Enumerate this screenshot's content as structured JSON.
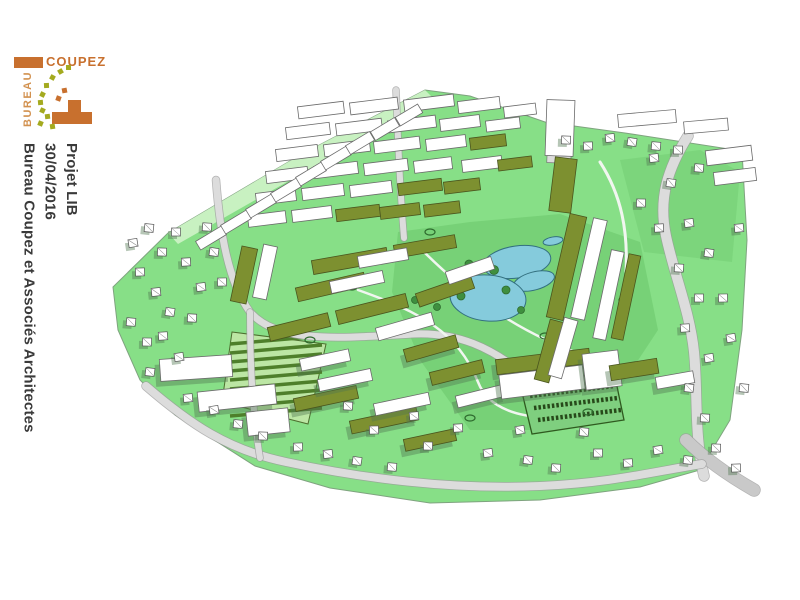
{
  "meta": {
    "title_lines": [
      "Projet LIB",
      "30/04/2016",
      "Bureau Coupez et Associés Architectes"
    ]
  },
  "logo": {
    "word_top": "COUPEZ",
    "word_side": "BUREAU",
    "orange": "#C8702E",
    "olive": "#A4AA1F",
    "squares": [
      [
        44,
        14,
        "olive"
      ],
      [
        52,
        10,
        "olive"
      ],
      [
        36,
        20,
        "olive"
      ],
      [
        30,
        28,
        "olive"
      ],
      [
        26,
        37,
        "olive"
      ],
      [
        24,
        45,
        "olive"
      ],
      [
        26,
        53,
        "olive"
      ],
      [
        31,
        59,
        "olive"
      ],
      [
        24,
        66,
        "olive"
      ],
      [
        36,
        69,
        "olive"
      ],
      [
        42,
        41,
        "orange"
      ],
      [
        48,
        33,
        "orange"
      ]
    ]
  },
  "colors": {
    "grass": "#87DF87",
    "grass_dark": "#63C063",
    "slope": "#CFF3C8",
    "terrain_edge": "#7FA37F",
    "water": "#85CBDC",
    "water_edge": "#33707F",
    "roof": "#7D9030",
    "roof_edge": "#4A551E",
    "line": "#6B6B6B",
    "white": "#FFFFFF",
    "road": "#DCDCDC",
    "road2": "#C9C9C9",
    "path": "#F1F6F0",
    "road_edge": "#9B9B9B",
    "shadow": "rgba(80,120,80,0.42)",
    "garden_light": "#BCE6A4",
    "garden_dark": "#4E7F2B",
    "parking": "#7FCF7F",
    "parking_edge": "#2F5A1F",
    "stall": "#27491A",
    "tree": "#3F8F3F",
    "tree_edge": "#2E6B2E"
  },
  "scene": {
    "terrain": [
      [
        113,
        287
      ],
      [
        168,
        233
      ],
      [
        300,
        155
      ],
      [
        425,
        90
      ],
      [
        470,
        96
      ],
      [
        545,
        122
      ],
      [
        625,
        133
      ],
      [
        742,
        151
      ],
      [
        747,
        240
      ],
      [
        742,
        330
      ],
      [
        730,
        420
      ],
      [
        700,
        470
      ],
      [
        640,
        487
      ],
      [
        540,
        500
      ],
      [
        430,
        503
      ],
      [
        330,
        488
      ],
      [
        255,
        466
      ],
      [
        175,
        415
      ],
      [
        140,
        380
      ],
      [
        118,
        330
      ]
    ],
    "slope": [
      [
        168,
        233
      ],
      [
        300,
        155
      ],
      [
        425,
        90
      ],
      [
        434,
        99
      ],
      [
        308,
        170
      ],
      [
        178,
        244
      ]
    ],
    "dark_patches": [
      {
        "pts": [
          [
            398,
            232
          ],
          [
            470,
            222
          ],
          [
            560,
            214
          ],
          [
            640,
            242
          ],
          [
            658,
            330
          ],
          [
            600,
            418
          ],
          [
            560,
            430
          ],
          [
            470,
            430
          ],
          [
            420,
            360
          ],
          [
            392,
            292
          ]
        ],
        "o": 0.45
      },
      {
        "pts": [
          [
            620,
            160
          ],
          [
            700,
            150
          ],
          [
            740,
            172
          ],
          [
            732,
            262
          ],
          [
            644,
            252
          ]
        ],
        "o": 0.3
      }
    ],
    "garden": {
      "pts": [
        [
          232,
          332
        ],
        [
          326,
          344
        ],
        [
          308,
          424
        ],
        [
          222,
          402
        ]
      ],
      "lines": [
        [
          230,
          344,
          322,
          336
        ],
        [
          230,
          353,
          322,
          345
        ],
        [
          230,
          362,
          322,
          354
        ],
        [
          230,
          371,
          322,
          363
        ],
        [
          230,
          380,
          322,
          372
        ],
        [
          230,
          389,
          322,
          381
        ],
        [
          230,
          398,
          322,
          390
        ],
        [
          230,
          407,
          322,
          399
        ],
        [
          230,
          416,
          322,
          408
        ]
      ]
    },
    "roads": [
      {
        "d": "M688,136 C668,168 658,198 666,236 C674,274 690,312 694,352 C698,392 694,436 704,476",
        "w": 10,
        "c": "road"
      },
      {
        "d": "M686,440 C702,456 726,474 754,490",
        "w": 12,
        "c": "road2"
      },
      {
        "d": "M146,386 C190,424 228,450 286,462 C360,478 450,490 540,486 C610,483 652,472 702,464",
        "w": 8,
        "c": "road"
      },
      {
        "d": "M396,90 C398,140 400,190 404,238",
        "w": 6,
        "c": "road"
      },
      {
        "d": "M216,180 C220,232 228,282 250,312 C278,344 340,338 414,334 C460,332 492,350 516,368",
        "w": 7,
        "c": "road"
      },
      {
        "d": "M250,312 C250,360 252,410 260,458",
        "w": 6,
        "c": "road"
      },
      {
        "d": "M420,248 C460,288 510,330 586,356",
        "w": 2.5,
        "c": "path"
      },
      {
        "d": "M358,290 C420,312 458,332 478,382 C488,408 520,420 560,416",
        "w": 2.5,
        "c": "path"
      },
      {
        "d": "M600,162 C622,196 628,232 626,272",
        "w": 3,
        "c": "path"
      }
    ],
    "parking": {
      "pts": [
        [
          520,
          384
        ],
        [
          614,
          372
        ],
        [
          624,
          420
        ],
        [
          532,
          434
        ]
      ],
      "rows": [
        [
          530,
          396,
          614,
          386
        ],
        [
          534,
          408,
          618,
          398
        ],
        [
          538,
          420,
          621,
          410
        ]
      ]
    },
    "ponds": [
      [
        517,
        262,
        34,
        16,
        -8
      ],
      [
        534,
        281,
        21,
        9,
        -15
      ],
      [
        488,
        298,
        38,
        23,
        5
      ],
      [
        553,
        241,
        10,
        4,
        -10
      ]
    ],
    "trees": [
      [
        469,
        264,
        4
      ],
      [
        481,
        267,
        4
      ],
      [
        494,
        270,
        4.5
      ],
      [
        506,
        290,
        4
      ],
      [
        461,
        296,
        4
      ],
      [
        437,
        307,
        3.5
      ],
      [
        415,
        300,
        3.5
      ],
      [
        521,
        310,
        3.5
      ],
      [
        398,
        330,
        3.5
      ],
      [
        560,
        332,
        3
      ]
    ],
    "bushes": [
      [
        352,
        287
      ],
      [
        430,
        232
      ],
      [
        545,
        336
      ],
      [
        470,
        418
      ],
      [
        400,
        408
      ],
      [
        588,
        412
      ],
      [
        310,
        340
      ],
      [
        624,
        300
      ]
    ],
    "buildings": [
      [
        298,
        104,
        46,
        12,
        -7,
        "w"
      ],
      [
        350,
        100,
        48,
        12,
        -7,
        "w"
      ],
      [
        404,
        97,
        50,
        12,
        -7,
        "w"
      ],
      [
        458,
        99,
        42,
        12,
        -7,
        "w"
      ],
      [
        504,
        105,
        32,
        11,
        -7,
        "w"
      ],
      [
        286,
        125,
        44,
        12,
        -7,
        "w"
      ],
      [
        336,
        121,
        46,
        12,
        -7,
        "w"
      ],
      [
        388,
        118,
        48,
        12,
        -7,
        "w"
      ],
      [
        440,
        117,
        40,
        12,
        -7,
        "w"
      ],
      [
        486,
        119,
        34,
        11,
        -7,
        "w"
      ],
      [
        276,
        147,
        42,
        12,
        -7,
        "w"
      ],
      [
        324,
        142,
        46,
        12,
        -7,
        "w"
      ],
      [
        374,
        139,
        46,
        12,
        -7,
        "w"
      ],
      [
        426,
        137,
        40,
        12,
        -7,
        "w"
      ],
      [
        470,
        136,
        36,
        12,
        -7,
        "r"
      ],
      [
        266,
        169,
        42,
        12,
        -7,
        "w"
      ],
      [
        314,
        164,
        44,
        12,
        -7,
        "w"
      ],
      [
        364,
        161,
        44,
        12,
        -7,
        "w"
      ],
      [
        414,
        159,
        38,
        12,
        -7,
        "w"
      ],
      [
        462,
        158,
        40,
        12,
        -7,
        "w"
      ],
      [
        498,
        158,
        34,
        11,
        -7,
        "r"
      ],
      [
        256,
        191,
        40,
        12,
        -7,
        "w"
      ],
      [
        302,
        186,
        42,
        12,
        -7,
        "w"
      ],
      [
        350,
        183,
        42,
        12,
        -7,
        "w"
      ],
      [
        398,
        181,
        44,
        12,
        -7,
        "r"
      ],
      [
        444,
        180,
        36,
        12,
        -7,
        "r"
      ],
      [
        248,
        213,
        38,
        12,
        -7,
        "w"
      ],
      [
        292,
        208,
        40,
        12,
        -7,
        "w"
      ],
      [
        336,
        207,
        44,
        12,
        -7,
        "r"
      ],
      [
        380,
        205,
        40,
        12,
        -7,
        "r"
      ],
      [
        424,
        203,
        36,
        12,
        -7,
        "r"
      ],
      [
        196,
        233,
        30,
        10,
        -31,
        "w"
      ],
      [
        221,
        217,
        30,
        10,
        -31,
        "w"
      ],
      [
        246,
        201,
        30,
        10,
        -31,
        "w"
      ],
      [
        271,
        185,
        30,
        10,
        -31,
        "w"
      ],
      [
        296,
        169,
        30,
        10,
        -31,
        "w"
      ],
      [
        321,
        153,
        30,
        10,
        -31,
        "w"
      ],
      [
        346,
        138,
        28,
        10,
        -31,
        "w"
      ],
      [
        371,
        124,
        28,
        10,
        -31,
        "w"
      ],
      [
        396,
        110,
        26,
        10,
        -31,
        "w"
      ],
      [
        236,
        247,
        16,
        56,
        12,
        "r"
      ],
      [
        258,
        245,
        14,
        54,
        12,
        "w"
      ],
      [
        312,
        254,
        76,
        14,
        -10,
        "r"
      ],
      [
        394,
        240,
        62,
        13,
        -10,
        "r"
      ],
      [
        296,
        280,
        70,
        14,
        -13,
        "r"
      ],
      [
        336,
        302,
        72,
        14,
        -14,
        "r"
      ],
      [
        268,
        320,
        62,
        14,
        -14,
        "r"
      ],
      [
        416,
        284,
        58,
        14,
        -19,
        "r"
      ],
      [
        446,
        264,
        48,
        13,
        -19,
        "w"
      ],
      [
        376,
        320,
        58,
        13,
        -16,
        "w"
      ],
      [
        404,
        342,
        54,
        13,
        -16,
        "r"
      ],
      [
        330,
        276,
        54,
        12,
        -12,
        "w"
      ],
      [
        358,
        252,
        50,
        12,
        -10,
        "w"
      ],
      [
        160,
        357,
        72,
        22,
        -4,
        "w"
      ],
      [
        198,
        388,
        78,
        20,
        -6,
        "w"
      ],
      [
        247,
        410,
        42,
        24,
        -6,
        "w"
      ],
      [
        294,
        392,
        64,
        13,
        -12,
        "r"
      ],
      [
        350,
        414,
        68,
        13,
        -12,
        "r"
      ],
      [
        404,
        434,
        52,
        12,
        -12,
        "r"
      ],
      [
        318,
        374,
        54,
        12,
        -12,
        "w"
      ],
      [
        374,
        398,
        56,
        12,
        -12,
        "w"
      ],
      [
        300,
        354,
        50,
        12,
        -12,
        "w"
      ],
      [
        430,
        366,
        54,
        13,
        -14,
        "r"
      ],
      [
        456,
        390,
        50,
        12,
        -14,
        "w"
      ],
      [
        496,
        354,
        94,
        15,
        -7,
        "r"
      ],
      [
        500,
        370,
        84,
        24,
        -7,
        "w"
      ],
      [
        584,
        352,
        36,
        36,
        -7,
        "w"
      ],
      [
        610,
        362,
        48,
        15,
        -9,
        "r"
      ],
      [
        656,
        374,
        38,
        12,
        -10,
        "w"
      ],
      [
        558,
        214,
        17,
        106,
        13,
        "r"
      ],
      [
        582,
        218,
        14,
        102,
        13,
        "w"
      ],
      [
        602,
        250,
        13,
        90,
        12,
        "w"
      ],
      [
        620,
        254,
        12,
        86,
        12,
        "r"
      ],
      [
        542,
        320,
        15,
        62,
        15,
        "r"
      ],
      [
        556,
        318,
        14,
        60,
        16,
        "w"
      ],
      [
        546,
        100,
        28,
        56,
        2,
        "t"
      ],
      [
        552,
        158,
        22,
        54,
        7,
        "r"
      ],
      [
        618,
        112,
        58,
        13,
        -5,
        "w"
      ],
      [
        684,
        120,
        44,
        12,
        -5,
        "w"
      ],
      [
        706,
        148,
        46,
        15,
        -7,
        "w"
      ],
      [
        714,
        170,
        42,
        13,
        -7,
        "w"
      ]
    ],
    "houses": [
      [
        133,
        243
      ],
      [
        149,
        228
      ],
      [
        162,
        252
      ],
      [
        140,
        272
      ],
      [
        156,
        292
      ],
      [
        170,
        312
      ],
      [
        131,
        322
      ],
      [
        147,
        342
      ],
      [
        186,
        262
      ],
      [
        201,
        287
      ],
      [
        214,
        252
      ],
      [
        207,
        227
      ],
      [
        176,
        232
      ],
      [
        163,
        336
      ],
      [
        179,
        357
      ],
      [
        150,
        372
      ],
      [
        192,
        318
      ],
      [
        222,
        282
      ],
      [
        188,
        398
      ],
      [
        214,
        410
      ],
      [
        238,
        424
      ],
      [
        263,
        436
      ],
      [
        298,
        447
      ],
      [
        328,
        454
      ],
      [
        357,
        461
      ],
      [
        392,
        467
      ],
      [
        428,
        446
      ],
      [
        458,
        428
      ],
      [
        488,
        453
      ],
      [
        528,
        460
      ],
      [
        556,
        468
      ],
      [
        598,
        453
      ],
      [
        628,
        463
      ],
      [
        658,
        450
      ],
      [
        688,
        460
      ],
      [
        348,
        406
      ],
      [
        374,
        430
      ],
      [
        414,
        416
      ],
      [
        520,
        430
      ],
      [
        584,
        432
      ],
      [
        716,
        448
      ],
      [
        736,
        468
      ],
      [
        654,
        158
      ],
      [
        671,
        183
      ],
      [
        699,
        168
      ],
      [
        641,
        203
      ],
      [
        659,
        228
      ],
      [
        689,
        223
      ],
      [
        709,
        253
      ],
      [
        679,
        268
      ],
      [
        699,
        298
      ],
      [
        685,
        328
      ],
      [
        709,
        358
      ],
      [
        689,
        388
      ],
      [
        705,
        418
      ],
      [
        723,
        298
      ],
      [
        739,
        228
      ],
      [
        731,
        338
      ],
      [
        744,
        388
      ],
      [
        566,
        140
      ],
      [
        588,
        146
      ],
      [
        610,
        138
      ],
      [
        632,
        142
      ],
      [
        656,
        146
      ],
      [
        678,
        150
      ]
    ]
  }
}
